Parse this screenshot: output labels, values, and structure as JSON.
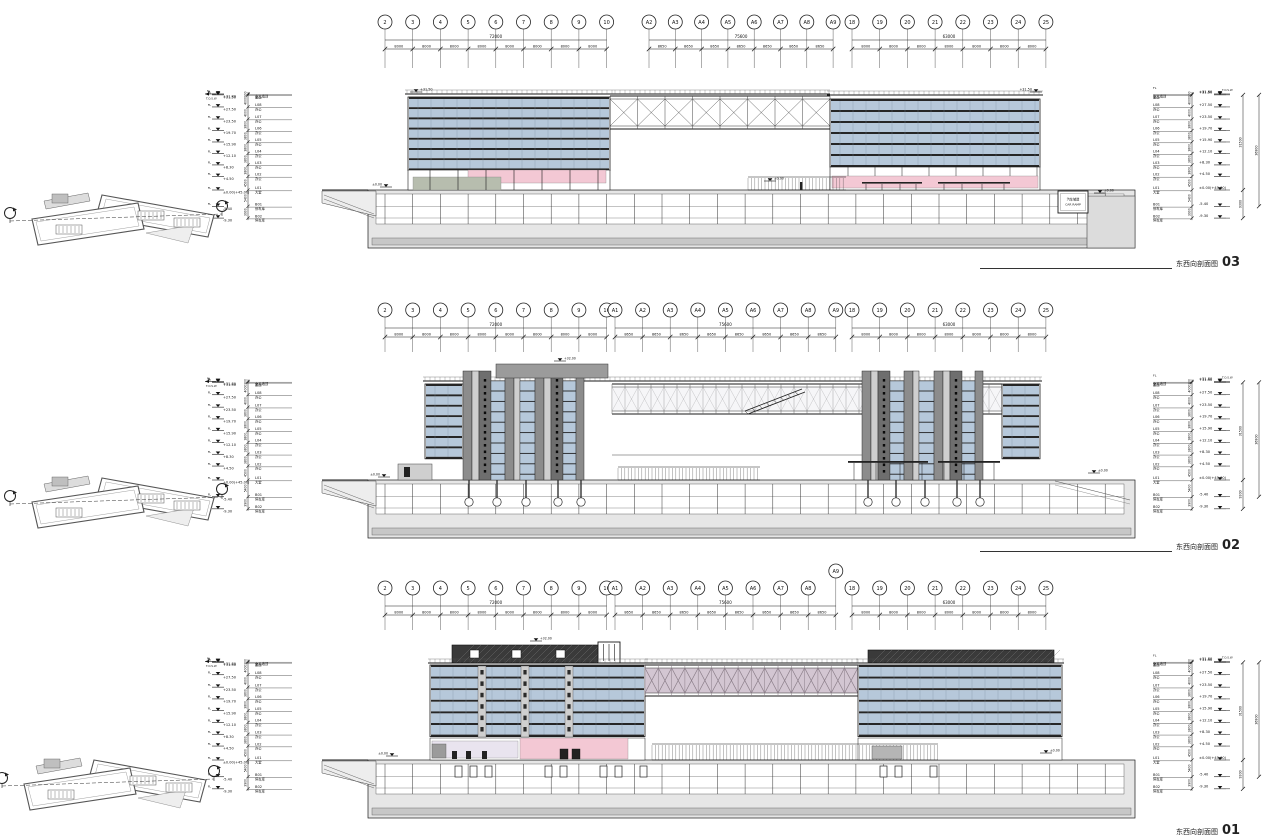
{
  "sheet": {
    "background": "#ffffff"
  },
  "titles": [
    {
      "name": "东西向剖面图",
      "number": "03"
    },
    {
      "name": "东西向剖面图",
      "number": "02"
    },
    {
      "name": "东西向剖面图",
      "number": "01"
    }
  ],
  "grid": {
    "span": "8000",
    "a_span": "8650",
    "totals": {
      "left": "72000",
      "middle": "75600",
      "right": "63000"
    },
    "left_bubbles": [
      "2",
      "3",
      "4",
      "5",
      "6",
      "7",
      "8",
      "9",
      "10"
    ],
    "a_bubbles_top": [
      "A2",
      "A3",
      "A4",
      "A5",
      "A6",
      "A7",
      "A8",
      "A9"
    ],
    "a_bubbles": [
      "A1",
      "A2",
      "A3",
      "A4",
      "A5",
      "A6",
      "A7",
      "A8",
      "A9"
    ],
    "right_bubbles": [
      "18",
      "19",
      "20",
      "21",
      "22",
      "23",
      "24",
      "25"
    ]
  },
  "levels": {
    "fl": "FL",
    "tos": "T.O.S.W",
    "rows": [
      {
        "code": "",
        "use": "女儿墙顶",
        "elev": "+31.80",
        "v": 31.8,
        "dim": "300"
      },
      {
        "code": "",
        "use": "屋面",
        "elev": "+31.50",
        "v": 31.5,
        "dim": "4000"
      },
      {
        "code": "L08",
        "use": "办公",
        "elev": "+27.50",
        "v": 27.5,
        "dim": "4000"
      },
      {
        "code": "L07",
        "use": "办公",
        "elev": "+23.50",
        "v": 23.5,
        "dim": "3800"
      },
      {
        "code": "L06",
        "use": "办公",
        "elev": "+19.70",
        "v": 19.7,
        "dim": "3800"
      },
      {
        "code": "L05",
        "use": "办公",
        "elev": "+15.90",
        "v": 15.9,
        "dim": "3800"
      },
      {
        "code": "L04",
        "use": "办公",
        "elev": "+12.10",
        "v": 12.1,
        "dim": "3800"
      },
      {
        "code": "L03",
        "use": "办公",
        "elev": "+8.30",
        "v": 8.3,
        "dim": "3800"
      },
      {
        "code": "L02",
        "use": "办公",
        "elev": "+4.50",
        "v": 4.5,
        "dim": "4500"
      },
      {
        "code": "L01",
        "use": "大堂",
        "elev": "±0.00(+45.00)",
        "v": 0,
        "dim": "5400"
      },
      {
        "code": "B01",
        "use": "停车库",
        "elev": "-5.40",
        "v": -5.4,
        "dim": "3900"
      },
      {
        "code": "B02",
        "use": "停车库",
        "elev": "-9.30",
        "v": -9.3,
        "dim": ""
      }
    ],
    "overall": [
      {
        "label": "31500",
        "from": 31.5,
        "to": 0
      },
      {
        "label": "36900",
        "from": 31.5,
        "to": -5.4
      }
    ],
    "below_overall": {
      "label": "9300",
      "from": 0,
      "to": -9.3
    }
  },
  "flags": {
    "roof": "+31.50",
    "zero": "±0.00",
    "mid_top": "+32.00"
  },
  "car_ramp": {
    "cn": "汽车坡道",
    "en": "CAR RAMP"
  },
  "colors": {
    "line": "#1a1a1a",
    "glass": "#b6c8da",
    "glass_light": "#cfdae5",
    "spandrel": "#262626",
    "mullion": "#7d8f9f",
    "pink": "#f3c8d4",
    "lavender": "#e9e4ef",
    "green": "#b7bdae",
    "ground_fill": "#e6e6e6",
    "found_fill": "#c7c7c7",
    "core_dark": "#6e6e6e",
    "core_light": "#cfcfcf",
    "roof_gray": "#9b9b9b",
    "truss_pink": "#d3c6d2",
    "dark_band": "#3a3a3a",
    "key_gray": "#bfbfbf"
  }
}
